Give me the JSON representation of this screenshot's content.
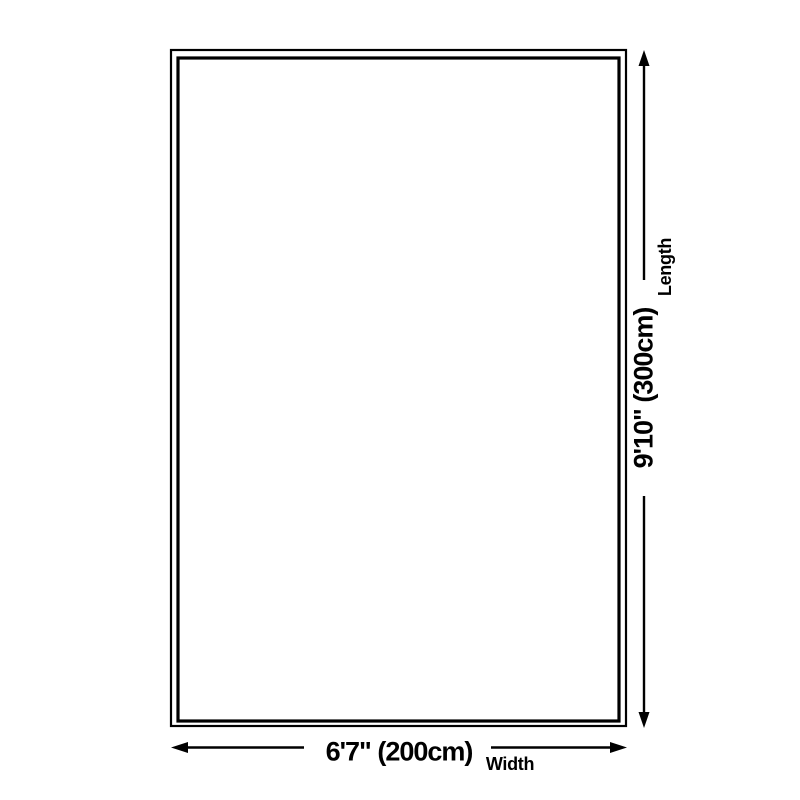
{
  "diagram": {
    "type": "product-size-diagram",
    "shape": "rectangle"
  },
  "dimensions": {
    "width": {
      "value": "6'7\" (200cm)",
      "label": "Width"
    },
    "length": {
      "value": "9'10\" (300cm)",
      "label": "Length"
    }
  },
  "colors": {
    "background": "#ffffff",
    "line": "#000000",
    "text": "#000000"
  }
}
